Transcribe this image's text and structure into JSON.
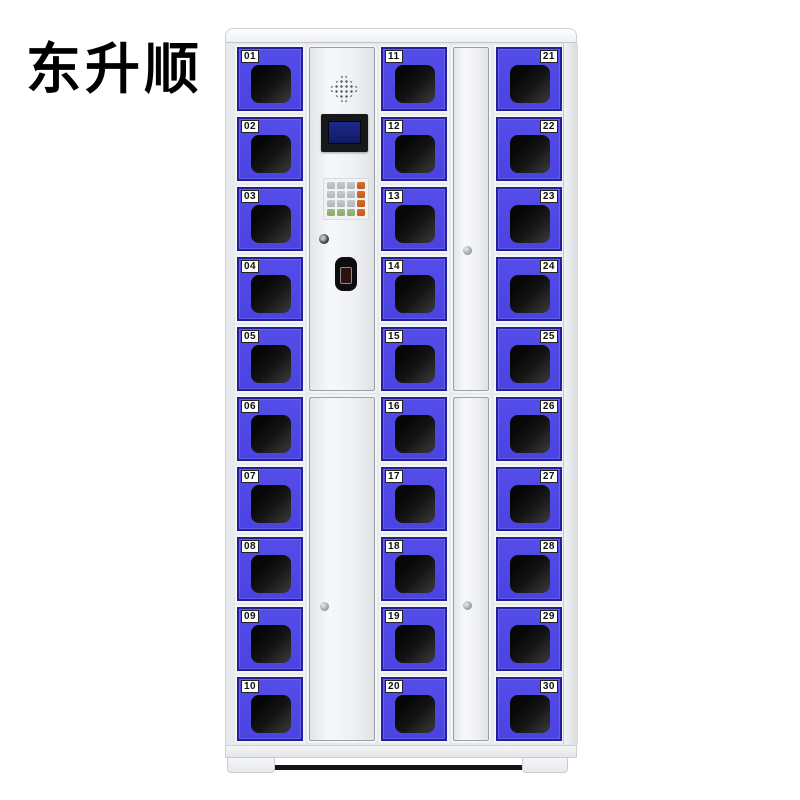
{
  "brand": {
    "name": "东升顺"
  },
  "cabinet": {
    "name": "smart-storage-locker-cabinet",
    "locker_count": 30,
    "columns": [
      {
        "id": "column-1",
        "label_side": "left",
        "lockers": [
          "01",
          "02",
          "03",
          "04",
          "05",
          "06",
          "07",
          "08",
          "09",
          "10"
        ]
      },
      {
        "id": "column-2",
        "label_side": "left",
        "lockers": [
          "11",
          "12",
          "13",
          "14",
          "15",
          "16",
          "17",
          "18",
          "19",
          "20"
        ]
      },
      {
        "id": "column-3",
        "label_side": "right",
        "lockers": [
          "21",
          "22",
          "23",
          "24",
          "25",
          "26",
          "27",
          "28",
          "29",
          "30"
        ]
      }
    ],
    "control_panel": {
      "speaker_icon": "speaker-grille",
      "screen_icon": "lcd-display",
      "keypad": {
        "rows": 4,
        "cols": 4,
        "gray_keys": 9,
        "green_keys": 3,
        "orange_keys": 4
      },
      "keyhole_icon": "keyhole",
      "lock_icon": "electronic-card-lock",
      "service_panel_lock_icon": "panel-screw"
    },
    "colors": {
      "door_blue": "#4a43e2",
      "door_border": "#23219a",
      "window_black": "#141414",
      "cabinet_body": "#e7e9ec",
      "screen_navy": "#121a63",
      "key_orange": "#c25a1a",
      "key_green": "#8aa96b",
      "key_gray": "#b0b5bb",
      "tag_bg": "#ffffff",
      "tag_text": "#111111"
    }
  }
}
